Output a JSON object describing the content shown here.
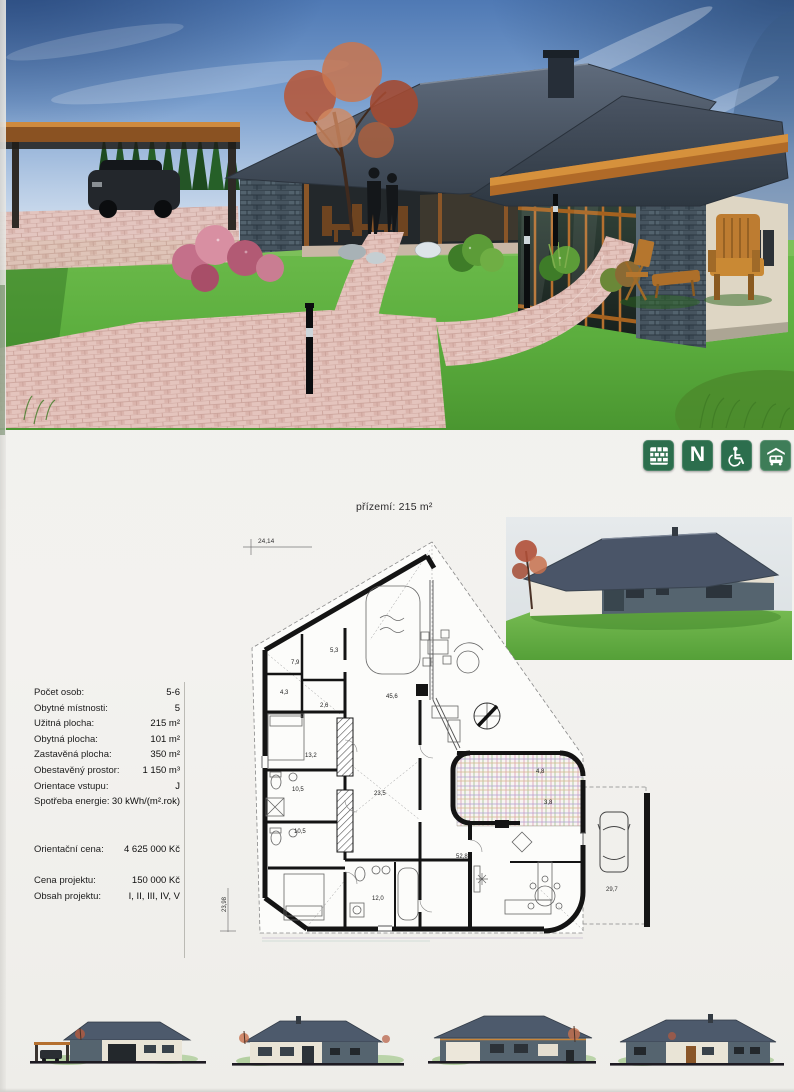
{
  "colors": {
    "icon_green": "#2c6e4d",
    "roof_slate": "#47525f",
    "wood_accent": "#b5702f",
    "grass_green": "#5aa83c",
    "paver_pink": "#e4c4bd"
  },
  "icons": [
    {
      "name": "brick-icon"
    },
    {
      "name": "letter-n-icon",
      "label": "N"
    },
    {
      "name": "wheelchair-icon"
    },
    {
      "name": "garage-icon"
    }
  ],
  "floor_plan": {
    "title": "přízemí: 215 m²",
    "dim_width": "24,14",
    "dim_height": "23,98",
    "dim_parking": "29,7",
    "rooms": [
      {
        "area": "5,3"
      },
      {
        "area": "7,9"
      },
      {
        "area": "4,3"
      },
      {
        "area": "2,6"
      },
      {
        "area": "45,6"
      },
      {
        "area": "13,2"
      },
      {
        "area": "10,5"
      },
      {
        "area": "23,5"
      },
      {
        "area": "10,5"
      },
      {
        "area": "12,0"
      },
      {
        "area": "52,8"
      },
      {
        "area": "3,8"
      },
      {
        "area": "4,8"
      }
    ]
  },
  "specs": {
    "rows": [
      {
        "label": "Počet osob:",
        "value": "5-6"
      },
      {
        "label": "Obytné místnosti:",
        "value": "5"
      },
      {
        "label": "Užitná plocha:",
        "value": "215 m²"
      },
      {
        "label": "Obytná plocha:",
        "value": "101 m²"
      },
      {
        "label": "Zastavěná plocha:",
        "value": "350 m²"
      },
      {
        "label": "Obestavěný prostor:",
        "value": "1 150 m³"
      },
      {
        "label": "Orientace vstupu:",
        "value": "J"
      },
      {
        "label": "Spotřeba energie:",
        "value": "30 kWh/(m².rok)"
      }
    ],
    "price": {
      "label": "Orientační cena:",
      "value": "4 625 000 Kč"
    },
    "project": [
      {
        "label": "Cena projektu:",
        "value": "150 000 Kč"
      },
      {
        "label": "Obsah projektu:",
        "value": "I, II, III, IV, V"
      }
    ]
  }
}
